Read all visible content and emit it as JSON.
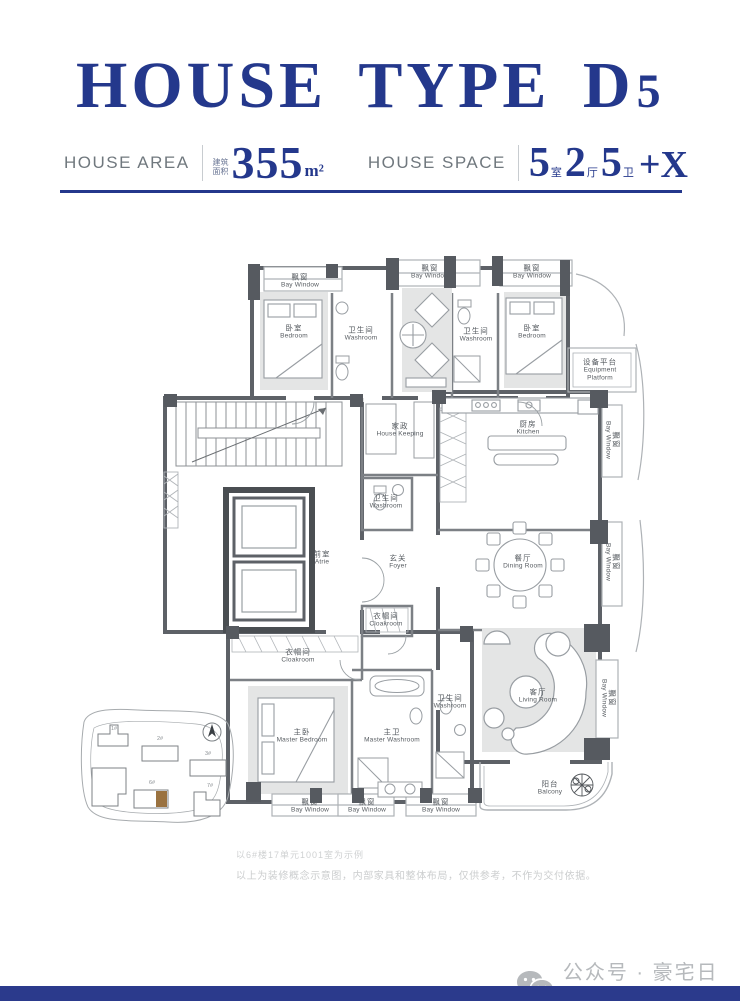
{
  "header": {
    "title_text": "HOUSE TYPE D",
    "title_digit": "5",
    "area": {
      "label": "HOUSE AREA",
      "prefix": "建筑面积",
      "value": "355",
      "unit": "m²"
    },
    "space": {
      "label": "HOUSE SPACE",
      "groups": [
        {
          "num": "5",
          "unit": "室"
        },
        {
          "num": "2",
          "unit": "厅"
        },
        {
          "num": "5",
          "unit": "卫"
        }
      ],
      "suffix": "+X"
    }
  },
  "plan": {
    "labels": [
      {
        "x": 220,
        "y": 41,
        "cn": "飘窗",
        "en": "Bay Window",
        "v": false
      },
      {
        "x": 350,
        "y": 32,
        "cn": "飘窗",
        "en": "Bay Window",
        "v": false
      },
      {
        "x": 452,
        "y": 32,
        "cn": "飘窗",
        "en": "Bay Window",
        "v": false
      },
      {
        "x": 214,
        "y": 92,
        "cn": "卧室",
        "en": "Bedroom",
        "v": false
      },
      {
        "x": 281,
        "y": 94,
        "cn": "卫生间",
        "en": "Washroom",
        "v": false
      },
      {
        "x": 396,
        "y": 95,
        "cn": "卫生间",
        "en": "Washroom",
        "v": false
      },
      {
        "x": 452,
        "y": 92,
        "cn": "卧室",
        "en": "Bedroom",
        "v": false
      },
      {
        "x": 520,
        "y": 130,
        "cn": "设备平台",
        "en": "Equipment Platform",
        "v": false
      },
      {
        "x": 320,
        "y": 190,
        "cn": "家政",
        "en": "House Keeping",
        "v": false
      },
      {
        "x": 448,
        "y": 188,
        "cn": "厨房",
        "en": "Kitchen",
        "v": false
      },
      {
        "x": 306,
        "y": 262,
        "cn": "卫生间",
        "en": "Washroom",
        "v": false
      },
      {
        "x": 242,
        "y": 318,
        "cn": "前室",
        "en": "Atrie",
        "v": false
      },
      {
        "x": 318,
        "y": 322,
        "cn": "玄关",
        "en": "Foyer",
        "v": false
      },
      {
        "x": 443,
        "y": 322,
        "cn": "餐厅",
        "en": "Dining Room",
        "v": false
      },
      {
        "x": 532,
        "y": 200,
        "cn": "飘窗",
        "en": "Bay Window",
        "v": true
      },
      {
        "x": 532,
        "y": 322,
        "cn": "飘窗",
        "en": "Bay Window",
        "v": true
      },
      {
        "x": 306,
        "y": 380,
        "cn": "衣帽间",
        "en": "Cloakroom",
        "v": false
      },
      {
        "x": 218,
        "y": 416,
        "cn": "衣帽间",
        "en": "Cloakroom",
        "v": false
      },
      {
        "x": 222,
        "y": 496,
        "cn": "主卧",
        "en": "Master Bedroom",
        "v": false
      },
      {
        "x": 312,
        "y": 496,
        "cn": "主卫",
        "en": "Master Washroom",
        "v": false
      },
      {
        "x": 370,
        "y": 462,
        "cn": "卫生间",
        "en": "Washroom",
        "v": false
      },
      {
        "x": 458,
        "y": 456,
        "cn": "客厅",
        "en": "Living Room",
        "v": false
      },
      {
        "x": 528,
        "y": 458,
        "cn": "飘窗",
        "en": "Bay Window",
        "v": true
      },
      {
        "x": 470,
        "y": 548,
        "cn": "阳台",
        "en": "Balcony",
        "v": false
      },
      {
        "x": 230,
        "y": 566,
        "cn": "飘窗",
        "en": "Bay Window",
        "v": false
      },
      {
        "x": 287,
        "y": 566,
        "cn": "飘窗",
        "en": "Bay Window",
        "v": false
      },
      {
        "x": 361,
        "y": 566,
        "cn": "飘窗",
        "en": "Bay Window",
        "v": false
      }
    ]
  },
  "site_map": {
    "highlight_color": "#9a7240",
    "building_labels": [
      {
        "x": 36,
        "y": 27,
        "t": "1#"
      },
      {
        "x": 82,
        "y": 37,
        "t": "2#"
      },
      {
        "x": 130,
        "y": 52,
        "t": "3#"
      },
      {
        "x": 74,
        "y": 81,
        "t": "6#"
      },
      {
        "x": 132,
        "y": 84,
        "t": "7#"
      }
    ]
  },
  "disclaimer": {
    "line1": "以6#楼17单元1001室为示例",
    "line2": "以上为装修概念示意图，内部家具和整体布局，仅供参考，不作为交付依据。"
  },
  "footer": {
    "account_label": "公众号 · 豪宅日记"
  },
  "colors": {
    "navy": "#24388c",
    "bar_navy": "#2b3a8c",
    "plan_wall": "#5d6167",
    "brown": "#9a7240"
  }
}
